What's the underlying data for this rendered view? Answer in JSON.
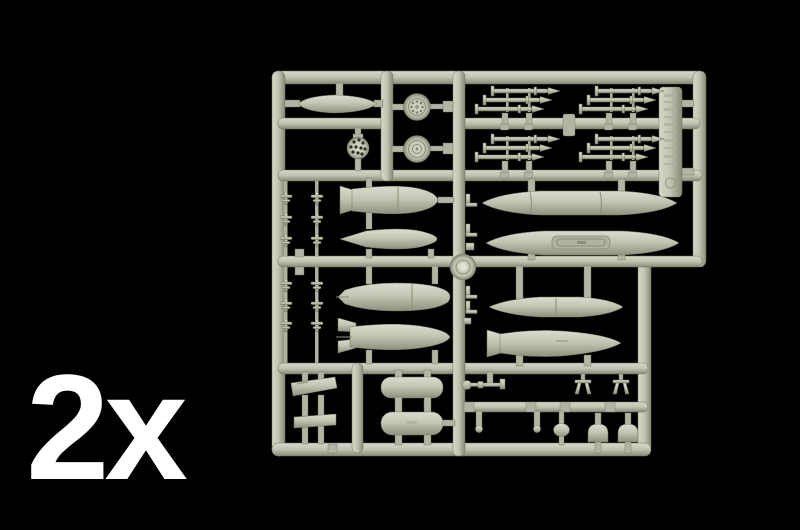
{
  "scene": {
    "type": "product-photo",
    "subject": "injection-molded model kit parts sprue (aircraft armament set: bombs, drop tanks, rocket clusters, wheels) on black background",
    "quantity_label": "2x",
    "colors": {
      "bg": "#000000",
      "label": "#ffffff",
      "plastic": "#c1c4b2",
      "plastic-light": "#d8dac9",
      "plastic-dark": "#8c8f7b"
    }
  },
  "sprue": {
    "id_tab": {
      "present": true,
      "embossed_text_legible": false
    },
    "parts": [
      {
        "name": "small fuel tank pod",
        "count": 1
      },
      {
        "name": "spoked main wheel",
        "count": 1
      },
      {
        "name": "wheel hub",
        "count": 1
      },
      {
        "name": "perforated ball dome",
        "count": 1
      },
      {
        "name": "stacked rocket cluster",
        "count": 4
      },
      {
        "name": "micro missile",
        "count": 12
      },
      {
        "name": "finned bomb",
        "count": 1
      },
      {
        "name": "sleek pointed bomb",
        "count": 1
      },
      {
        "name": "large rounded bomb",
        "count": 1
      },
      {
        "name": "box-fin bomb",
        "count": 1
      },
      {
        "name": "large drop tank",
        "count": 2
      },
      {
        "name": "slim tank pod",
        "count": 1
      },
      {
        "name": "flared-nose pod",
        "count": 1
      },
      {
        "name": "pylon plate",
        "count": 2
      },
      {
        "name": "cylindrical gun pod",
        "count": 2
      },
      {
        "name": "pitot probe",
        "count": 1
      },
      {
        "name": "small brace",
        "count": 2
      },
      {
        "name": "ball-tip pin",
        "count": 2
      },
      {
        "name": "round knob",
        "count": 1
      },
      {
        "name": "fin fairing",
        "count": 2
      }
    ]
  }
}
